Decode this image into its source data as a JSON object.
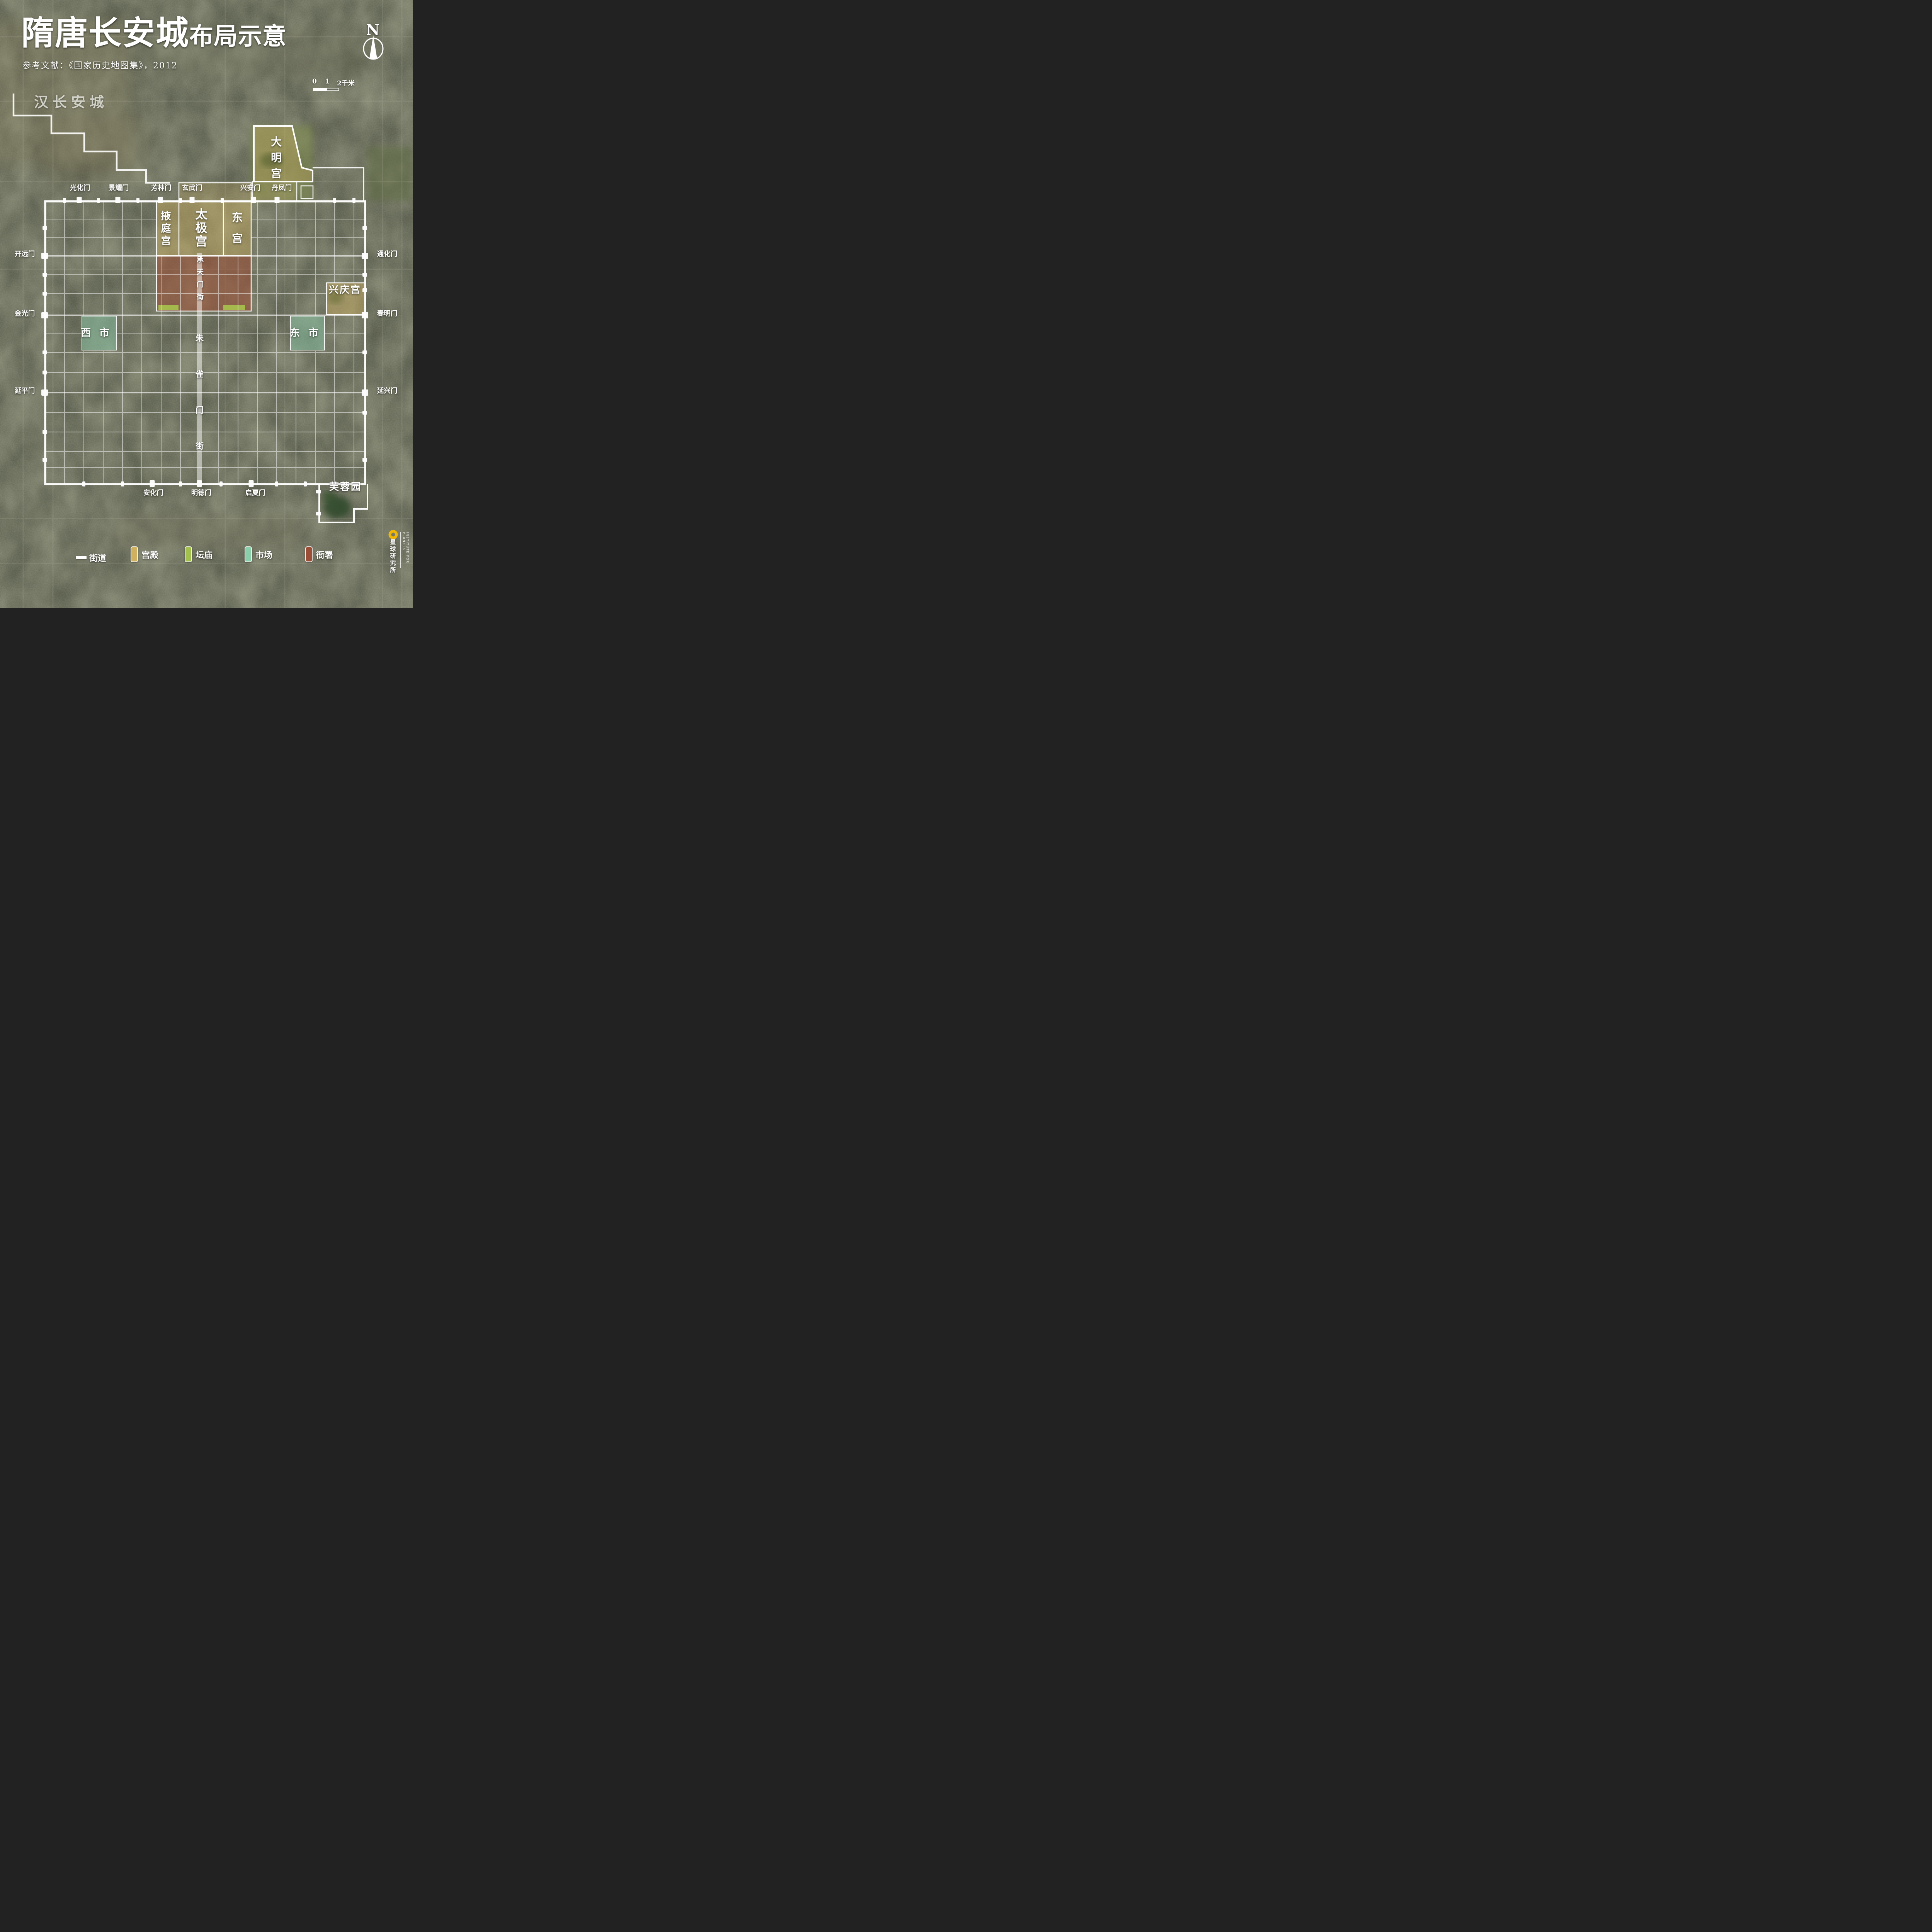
{
  "header": {
    "title_main": "隋唐长安城",
    "title_sub": "布局示意",
    "reference": "参考文献：《国家历史地图集》，2012"
  },
  "compass": {
    "label": "N"
  },
  "scalebar": {
    "tick0": "0",
    "tick1": "1",
    "tick2": "2千米"
  },
  "context": {
    "han_city": "汉长安城"
  },
  "sites": {
    "daminggong": "大明宫",
    "yetinggong": "掖庭宫",
    "taijigong": "太极宫",
    "donggong": "东宫",
    "xingqinggong": "兴庆宫",
    "west_market": "西市",
    "east_market": "东市",
    "furong_garden": "芙蓉园",
    "chengtianmen_street": "承天门街",
    "zhuquemen_street": "朱雀门街"
  },
  "gates": {
    "north": [
      "光化门",
      "景耀门",
      "芳林门",
      "玄武门",
      "兴安门",
      "丹凤门"
    ],
    "west": [
      "开远门",
      "金光门",
      "延平门"
    ],
    "east": [
      "通化门",
      "春明门",
      "延兴门"
    ],
    "south": [
      "安化门",
      "明德门",
      "启夏门"
    ]
  },
  "legend": {
    "items": [
      {
        "label": "街道",
        "type": "street",
        "color": "#ffffff"
      },
      {
        "label": "宫殿",
        "type": "palace",
        "color": "#d9b75f"
      },
      {
        "label": "坛庙",
        "type": "altar",
        "color": "#a9c94c"
      },
      {
        "label": "市场",
        "type": "market",
        "color": "#8fd9b4"
      },
      {
        "label": "衙署",
        "type": "office",
        "color": "#a04a31"
      }
    ]
  },
  "colors": {
    "palace": "#d9b75f",
    "altar": "#a9c94c",
    "market": "#8fd9b4",
    "office": "#a04a31",
    "street": "#ffffff",
    "wall": "#ffffff",
    "logo_accent": "#f2b705"
  },
  "logo": {
    "cn": "星球研究所",
    "en": "INSTITUTE FOR PLANETS"
  }
}
